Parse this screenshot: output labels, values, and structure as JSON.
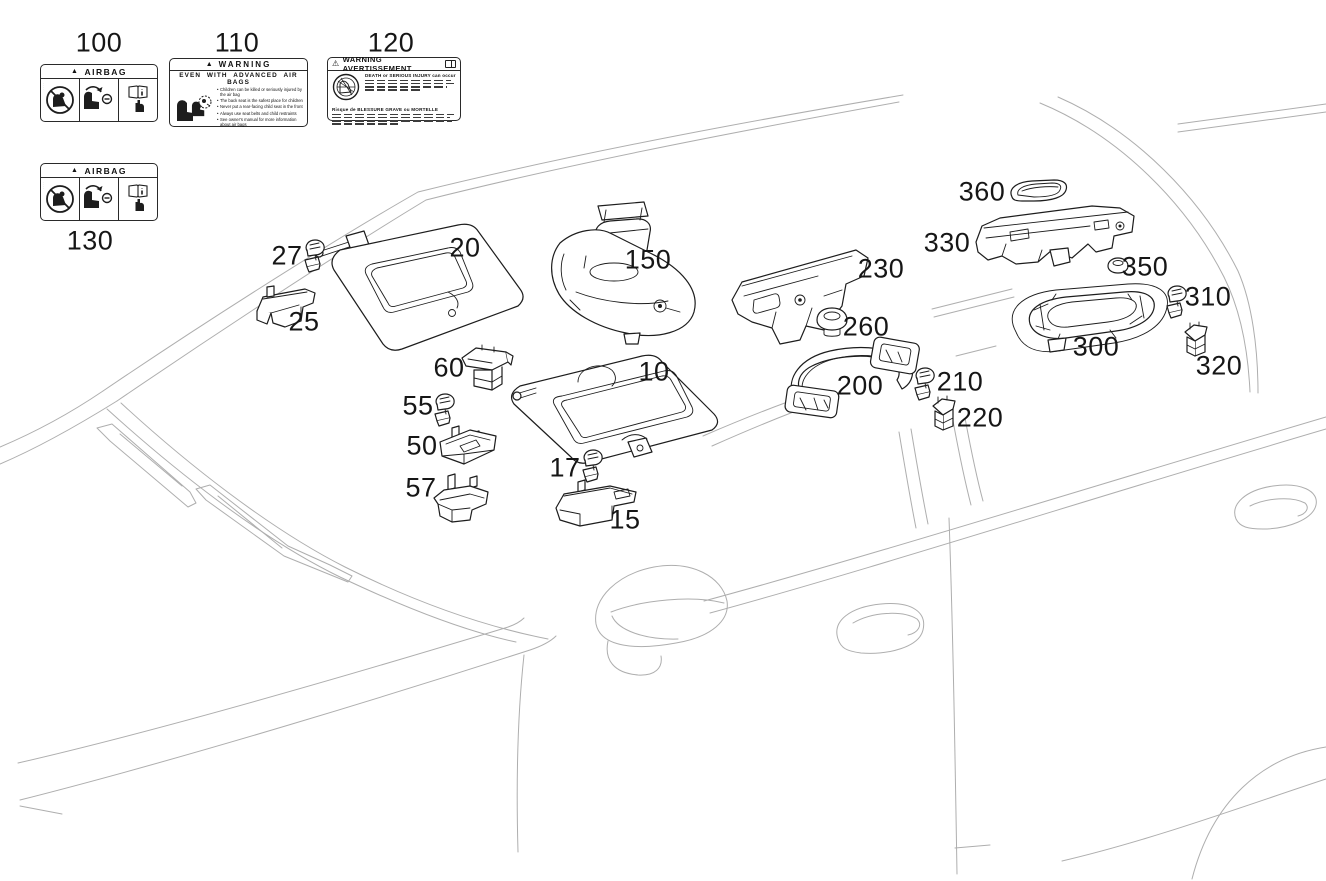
{
  "diagram": {
    "description": "Sun visor, assist grip and airbag label parts diagram",
    "colors": {
      "background": "#ffffff",
      "part_line": "#1d1d1d",
      "car_line": "#aeaeae",
      "text": "#161616"
    },
    "callouts": [
      {
        "ref": "100",
        "x": 99,
        "y": 43
      },
      {
        "ref": "110",
        "x": 237,
        "y": 43
      },
      {
        "ref": "120",
        "x": 391,
        "y": 43
      },
      {
        "ref": "130",
        "x": 90,
        "y": 241
      },
      {
        "ref": "27",
        "x": 287,
        "y": 256
      },
      {
        "ref": "25",
        "x": 304,
        "y": 322
      },
      {
        "ref": "20",
        "x": 465,
        "y": 248
      },
      {
        "ref": "60",
        "x": 449,
        "y": 368
      },
      {
        "ref": "150",
        "x": 648,
        "y": 260
      },
      {
        "ref": "10",
        "x": 654,
        "y": 372
      },
      {
        "ref": "55",
        "x": 418,
        "y": 406
      },
      {
        "ref": "50",
        "x": 422,
        "y": 446
      },
      {
        "ref": "17",
        "x": 565,
        "y": 468
      },
      {
        "ref": "57",
        "x": 421,
        "y": 488
      },
      {
        "ref": "15",
        "x": 625,
        "y": 520
      },
      {
        "ref": "230",
        "x": 881,
        "y": 269
      },
      {
        "ref": "260",
        "x": 866,
        "y": 327
      },
      {
        "ref": "200",
        "x": 860,
        "y": 386
      },
      {
        "ref": "210",
        "x": 960,
        "y": 382
      },
      {
        "ref": "220",
        "x": 980,
        "y": 418
      },
      {
        "ref": "360",
        "x": 982,
        "y": 192
      },
      {
        "ref": "330",
        "x": 947,
        "y": 243
      },
      {
        "ref": "350",
        "x": 1145,
        "y": 267
      },
      {
        "ref": "310",
        "x": 1208,
        "y": 297
      },
      {
        "ref": "300",
        "x": 1096,
        "y": 347
      },
      {
        "ref": "320",
        "x": 1219,
        "y": 366
      }
    ]
  },
  "airbag_label": {
    "header": "AIRBAG"
  },
  "warning_label_110": {
    "header": "WARNING",
    "subheader": "EVEN WITH ADVANCED AIR BAGS",
    "bullets": [
      "Children can be killed or seriously injured by the air bag",
      "The back seat is the safest place for children",
      "Never put a rear-facing child seat in the front",
      "Always use seat belts and child restraints",
      "See owner's manual for more information about air bags"
    ]
  },
  "warning_label_120": {
    "header": "WARNING AVERTISSEMENT",
    "english": "DEATH or SERIOUS INJURY can occur",
    "french": "Risque de BLESSURE GRAVE ou MORTELLE"
  }
}
